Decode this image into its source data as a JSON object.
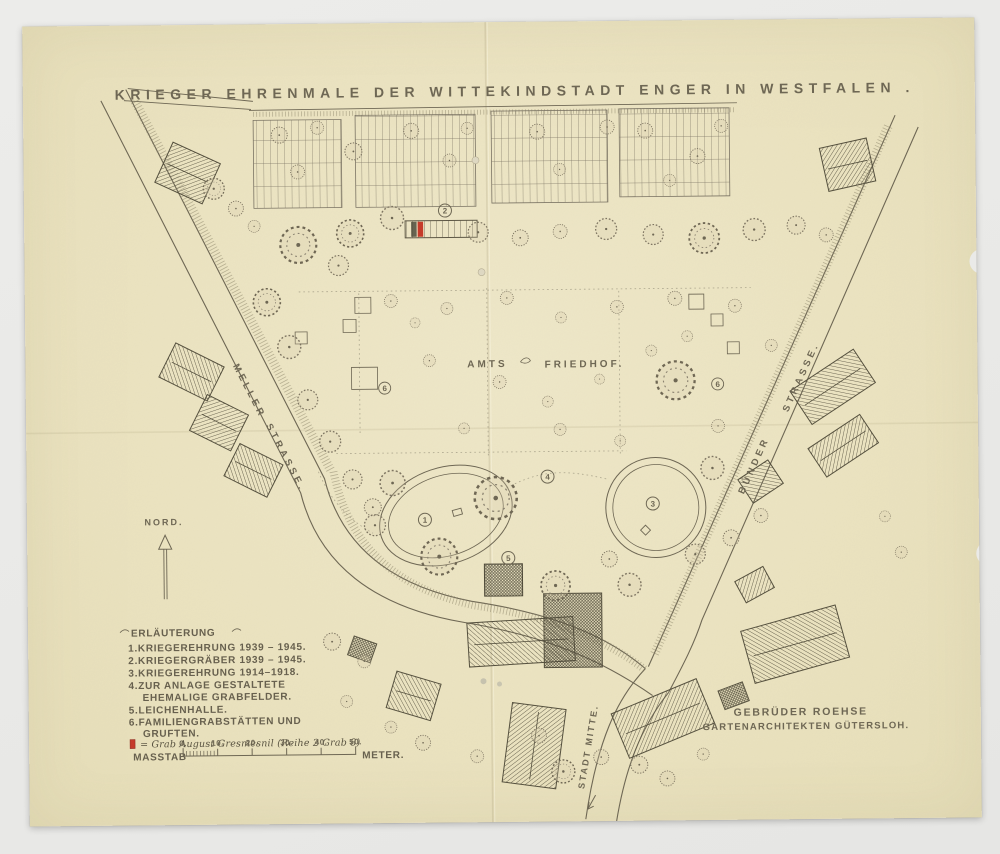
{
  "document": {
    "title": "KRIEGER EHRENMALE DER WITTEKINDSTADT ENGER IN WESTFALEN ."
  },
  "map": {
    "labels": {
      "cemetery_left": "AMTS",
      "cemetery_right": "FRIEDHOF.",
      "street_left_top": "MELLER",
      "street_left_bottom": "STRASSE.",
      "street_right_top": "STRASSE.",
      "street_right_bottom": "BÜNDER",
      "city_direction": "STADT MITTE.",
      "north": "NORD."
    },
    "markers": {
      "m1": "1",
      "m2": "2",
      "m3": "3",
      "m4": "4",
      "m5": "5",
      "m6a": "6",
      "m6b": "6"
    }
  },
  "legend": {
    "heading": "ERLÄUTERUNG",
    "items": [
      "1.KRIEGEREHRUNG 1939 – 1945.",
      "2.KRIEGERGRÄBER 1939 – 1945.",
      "3.KRIEGEREHRUNG 1914–1918.",
      "4.ZUR ANLAGE GESTALTETE",
      "EHEMALIGE GRABFELDER.",
      "5.LEICHENHALLE.",
      "6.FAMILIENGRABSTÄTTEN UND",
      "GRUFTEN."
    ],
    "handwritten_note": "= Grab August Gresmesnil (Reihe 2 Grab 8)"
  },
  "scale": {
    "label": "MASSTAB",
    "ticks": [
      "0.",
      "10.",
      "20.",
      "30.",
      "40.",
      "50."
    ],
    "unit": "METER."
  },
  "credit": {
    "line1": "GEBRÜDER ROEHSE",
    "line2": "GARTENARCHITEKTEN GÜTERSLOH."
  },
  "colors": {
    "background": "#eaeae8",
    "paper": "#ece4c1",
    "ink": "#6e6754",
    "accent_red": "#c53b2a"
  }
}
